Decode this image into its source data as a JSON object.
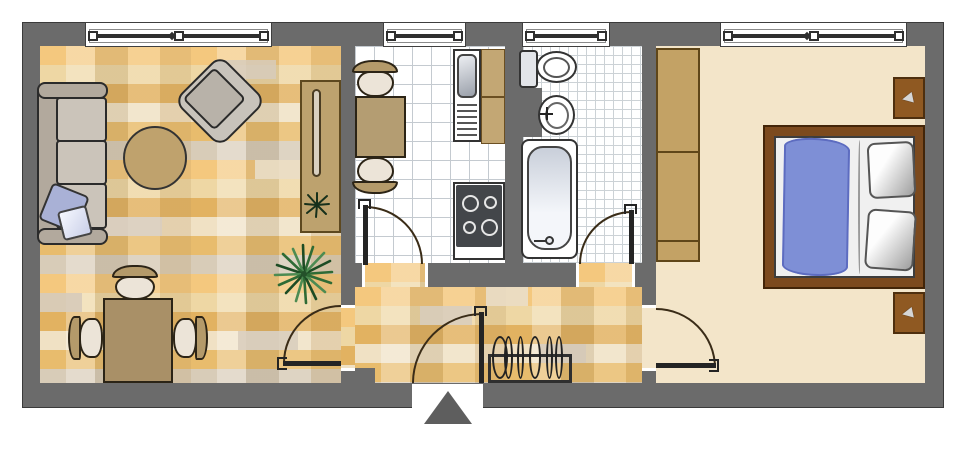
{
  "plan": {
    "type": "apartment-floor-plan",
    "rooms": [
      {
        "id": "living-room",
        "floor": "wood-parquet",
        "items": [
          "sofa-3-seat",
          "sofa-pillow",
          "round-rug",
          "armchair-rotated",
          "sideboard-shelf",
          "potted-plant-small",
          "potted-plant-large",
          "dining-table",
          "dining-chair",
          "dining-chair",
          "dining-chair"
        ]
      },
      {
        "id": "kitchen",
        "floor": "tile-large",
        "items": [
          "kitchen-table",
          "kitchen-chair",
          "kitchen-chair",
          "sink-unit",
          "counter-top",
          "stove-4-burner"
        ]
      },
      {
        "id": "bathroom",
        "floor": "tile-small",
        "items": [
          "toilet",
          "washbasin",
          "bathtub"
        ]
      },
      {
        "id": "hallway",
        "floor": "wood-parquet",
        "items": [
          "coat-rack-with-hangers"
        ]
      },
      {
        "id": "bedroom",
        "floor": "carpet",
        "items": [
          "wardrobe-2-door",
          "double-bed",
          "blue-blanket",
          "bed-pillow",
          "bed-pillow",
          "nightstand",
          "nightstand"
        ]
      }
    ],
    "windows": [
      {
        "room": "living-room",
        "mullion": "center"
      },
      {
        "room": "kitchen",
        "mullion": "none"
      },
      {
        "room": "bathroom",
        "mullion": "none"
      },
      {
        "room": "bedroom",
        "mullion": "center"
      }
    ],
    "doors": [
      {
        "from": "hallway",
        "to": "living-room",
        "swing": "into-living-room"
      },
      {
        "from": "hallway",
        "to": "kitchen",
        "swing": "into-kitchen"
      },
      {
        "from": "hallway",
        "to": "bathroom",
        "swing": "into-bathroom"
      },
      {
        "from": "hallway",
        "to": "bedroom",
        "swing": "into-bedroom"
      },
      {
        "from": "outside",
        "to": "hallway",
        "type": "entrance-door",
        "marker": "up-arrow-triangle"
      }
    ]
  },
  "colors": {
    "wall": "#6b6b6b",
    "wood_base": "#edc27c",
    "tile": "#ffffff",
    "carpet": "#f3e5c9",
    "wardrobe_tan": "#c3a265",
    "table_tan": "#a99067",
    "counter_tan": "#c3a774",
    "bed_frame_brown": "#7c4a1e",
    "nightstand_brown": "#8f5922",
    "blanket_blue": "#7e8fd6",
    "sofa_gray": "#cbc4ba",
    "plant_green": "#2f6b35",
    "arrow_gray": "#5e5e5e",
    "outline_dark": "#2a2a2a"
  }
}
